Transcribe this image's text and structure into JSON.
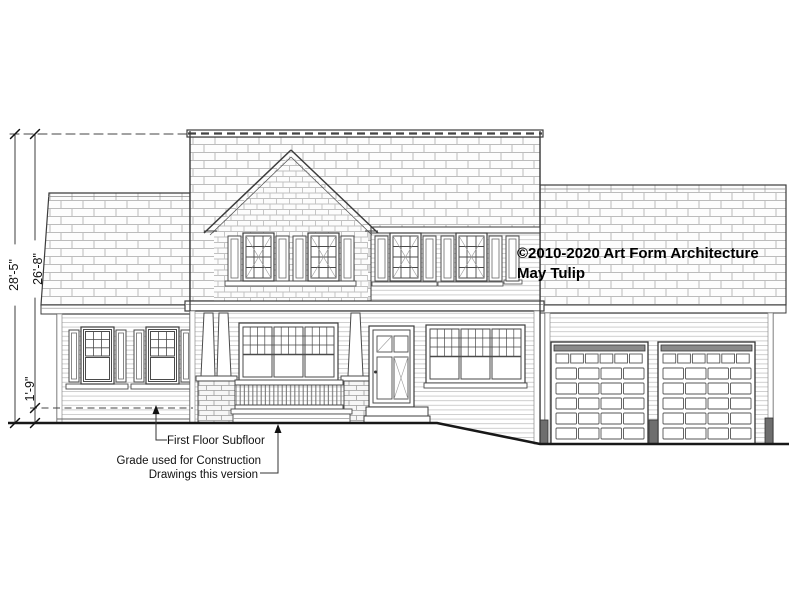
{
  "drawing": {
    "dimensions": {
      "overall": "28'-5\"",
      "ridge_to_subfloor": "26'-8\"",
      "subfloor_to_grade": "1'-9\""
    },
    "labels": {
      "subfloor": "First Floor Subfloor",
      "grade_line1": "Grade used for Construction",
      "grade_line2": "Drawings this version"
    },
    "copyright": {
      "line1": "©2010-2020 Art Form Architecture",
      "line2": "May Tulip"
    },
    "colors": {
      "ink": "#1a1a1a",
      "line": "#3c3c3c",
      "texture": "#bdbdbd",
      "background": "#ffffff"
    }
  }
}
